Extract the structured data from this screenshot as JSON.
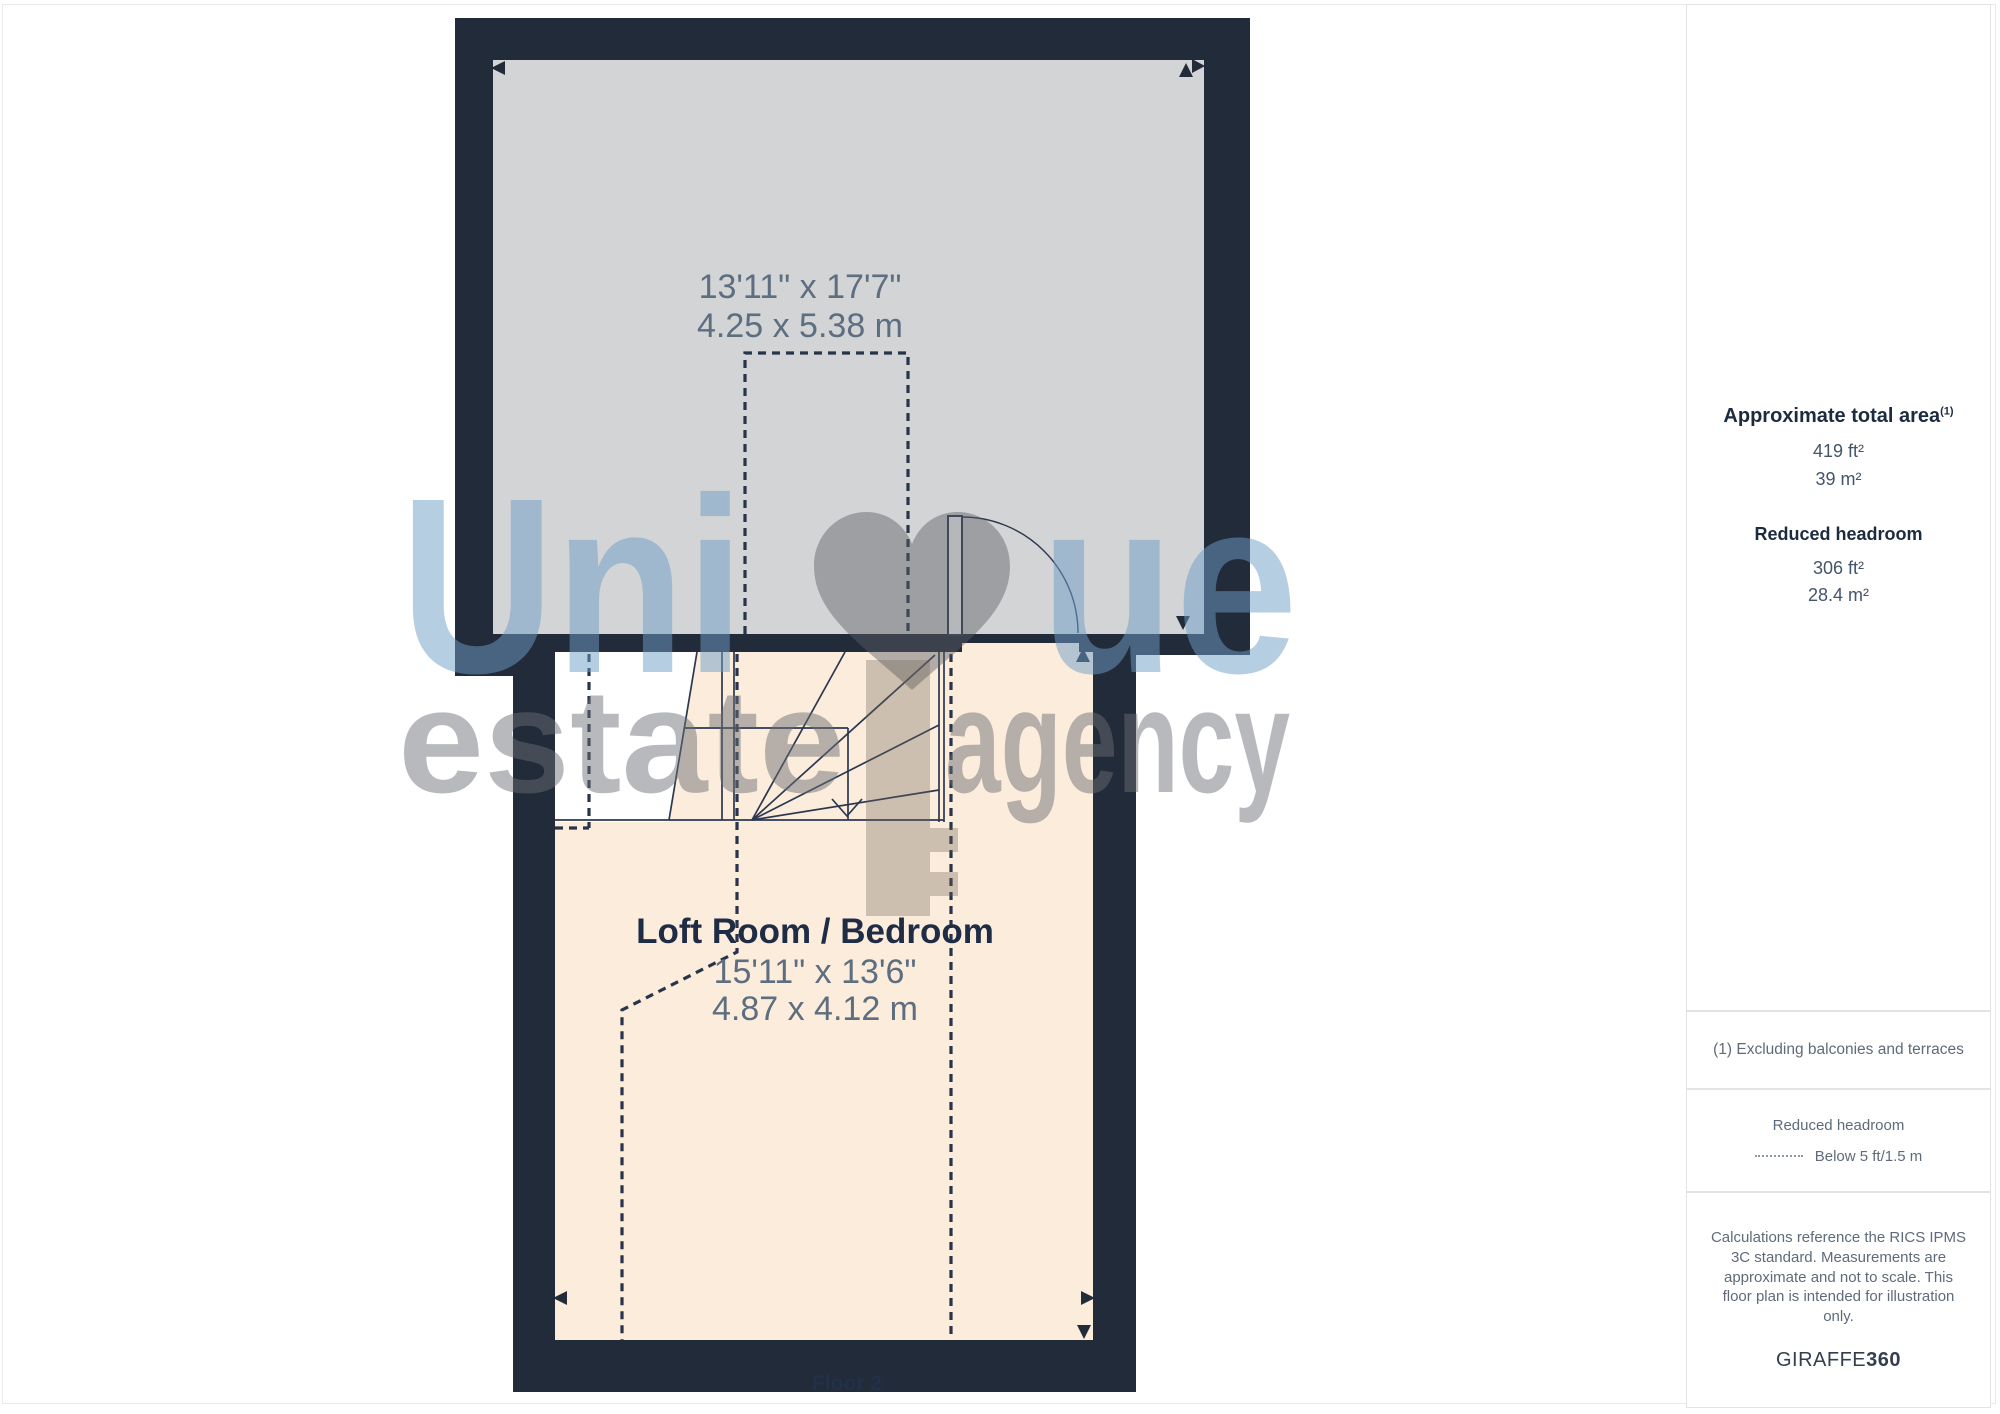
{
  "plan": {
    "floor_label": "Floor 2",
    "upper_room": {
      "dims_imperial": "13'11\" x 17'7\"",
      "dims_metric": "4.25 x 5.38 m"
    },
    "lower_room": {
      "name": "Loft Room / Bedroom",
      "dims_imperial": "15'11\" x 13'6\"",
      "dims_metric": "4.87 x 4.12 m"
    }
  },
  "watermark": {
    "part1": "Uni",
    "part2": "ue",
    "line2_left": "estate",
    "line2_right": "agency"
  },
  "sidebar": {
    "total_area": {
      "heading": "Approximate total area",
      "footnote_marker": "(1)",
      "value_imperial": "419 ft²",
      "value_metric": "39 m²"
    },
    "reduced_headroom": {
      "heading": "Reduced headroom",
      "value_imperial": "306 ft²",
      "value_metric": "28.4 m²"
    },
    "footnote": "(1) Excluding balconies and terraces",
    "legend": {
      "title": "Reduced headroom",
      "item": "Below 5 ft/1.5 m"
    },
    "disclaimer": "Calculations reference the RICS IPMS 3C standard. Measurements are approximate and not to scale. This floor plan is intended for illustration only.",
    "brand": {
      "name": "GIRAFFE",
      "suffix": "360"
    }
  },
  "colors": {
    "wall": "#212B39",
    "room-gray": "#D3D4D6",
    "room-peach": "#FCECDB",
    "accent-text": "#22304A",
    "dim-text": "#5D6E80",
    "wm-blue": "#6F9EC7",
    "wm-gray": "#6B6F75"
  }
}
